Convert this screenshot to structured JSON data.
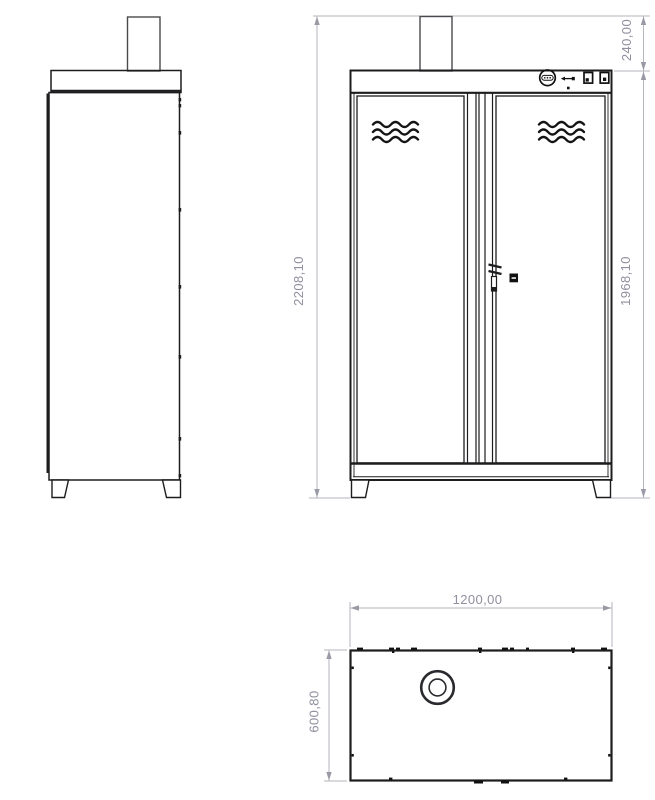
{
  "drawing": {
    "dimensions": {
      "stack_height": "240,00",
      "overall_height": "2208,10",
      "cabinet_height": "1968,10",
      "overall_width": "1200,00",
      "overall_depth": "600,80"
    },
    "icons": {
      "control_dial": "dial-icon",
      "usb_port": "usb-icon",
      "rocker_switches": "switch-icon",
      "door_lock": "lock-icon",
      "door_handle": "handle-icon",
      "door_vents": "vent-wave-icon",
      "exhaust_outlet": "exhaust-circle-icon"
    },
    "colors": {
      "outline": "#1d1d1f",
      "secondary_line": "#4a4a4e",
      "dimension_line": "#b6b6bd",
      "dimension_text": "#8f8f9e",
      "background": "#ffffff"
    }
  }
}
